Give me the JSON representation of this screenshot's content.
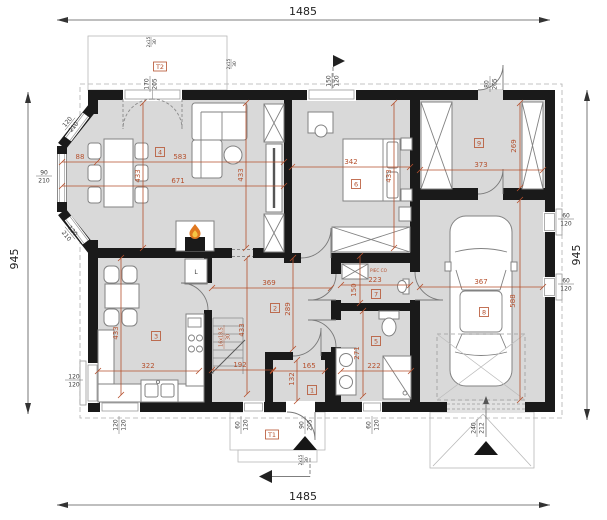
{
  "colors": {
    "wall": "#1a1a1a",
    "floor": "#d9d9d9",
    "dimension": "#b5502d"
  },
  "outer": {
    "top": "1485",
    "bottom": "1485",
    "left": "945",
    "right": "945"
  },
  "rooms": {
    "vestibule": "1",
    "hall": "2",
    "kitchen": "3",
    "living": "4",
    "bath": "5",
    "bedroom": "6",
    "wc": "7",
    "garage": "8",
    "wardrobe": "9"
  },
  "dims": {
    "living": {
      "bay": "88",
      "main": "583",
      "total": "671",
      "left": "433",
      "right": "433"
    },
    "bedroom": {
      "w": "342",
      "h": "433"
    },
    "wardrobe": {
      "w": "373",
      "h": "269"
    },
    "garage": {
      "w": "367",
      "h": "588"
    },
    "kitchen": {
      "w": "322",
      "h": "433"
    },
    "hall": {
      "w": "369",
      "h": "289",
      "h2": "433",
      "w2": "192"
    },
    "wc": {
      "w": "223",
      "h": "150"
    },
    "bath": {
      "w": "222",
      "h": "271"
    },
    "vestibule": {
      "w": "165",
      "h": "132"
    }
  },
  "openings": {
    "t2": {
      "tag": "T2",
      "w": "170",
      "h": "205"
    },
    "t1": {
      "tag": "T1",
      "w": "90",
      "h": "205"
    },
    "bedroom_window": {
      "w": "150",
      "h": "120"
    },
    "back_door": {
      "w": "80",
      "h": "205"
    },
    "bay_upper": {
      "w": "120",
      "h": "210"
    },
    "bay_front": {
      "w": "90",
      "h": "210"
    },
    "bay_lower": {
      "w": "120",
      "h": "210"
    },
    "kitchen_side": {
      "w": "120",
      "h": "120"
    },
    "kitchen_bottom": {
      "w": "120",
      "h": "120"
    },
    "hall_bottom": {
      "w": "60",
      "h": "120"
    },
    "bath_bottom": {
      "w": "60",
      "h": "120"
    },
    "garage_win1": {
      "w": "60",
      "h": "120"
    },
    "garage_win2": {
      "w": "60",
      "h": "120"
    },
    "garage_door": {
      "w": "240",
      "h": "212"
    }
  },
  "annotations": {
    "stairs": {
      "steps": "16x18,5",
      "tread": "30"
    },
    "terrace_steps": {
      "a": "2x15",
      "b": "30"
    },
    "porch_steps": {
      "a": "2x15",
      "b": "30"
    },
    "boiler": "PIEC CO",
    "fridge": "L"
  }
}
